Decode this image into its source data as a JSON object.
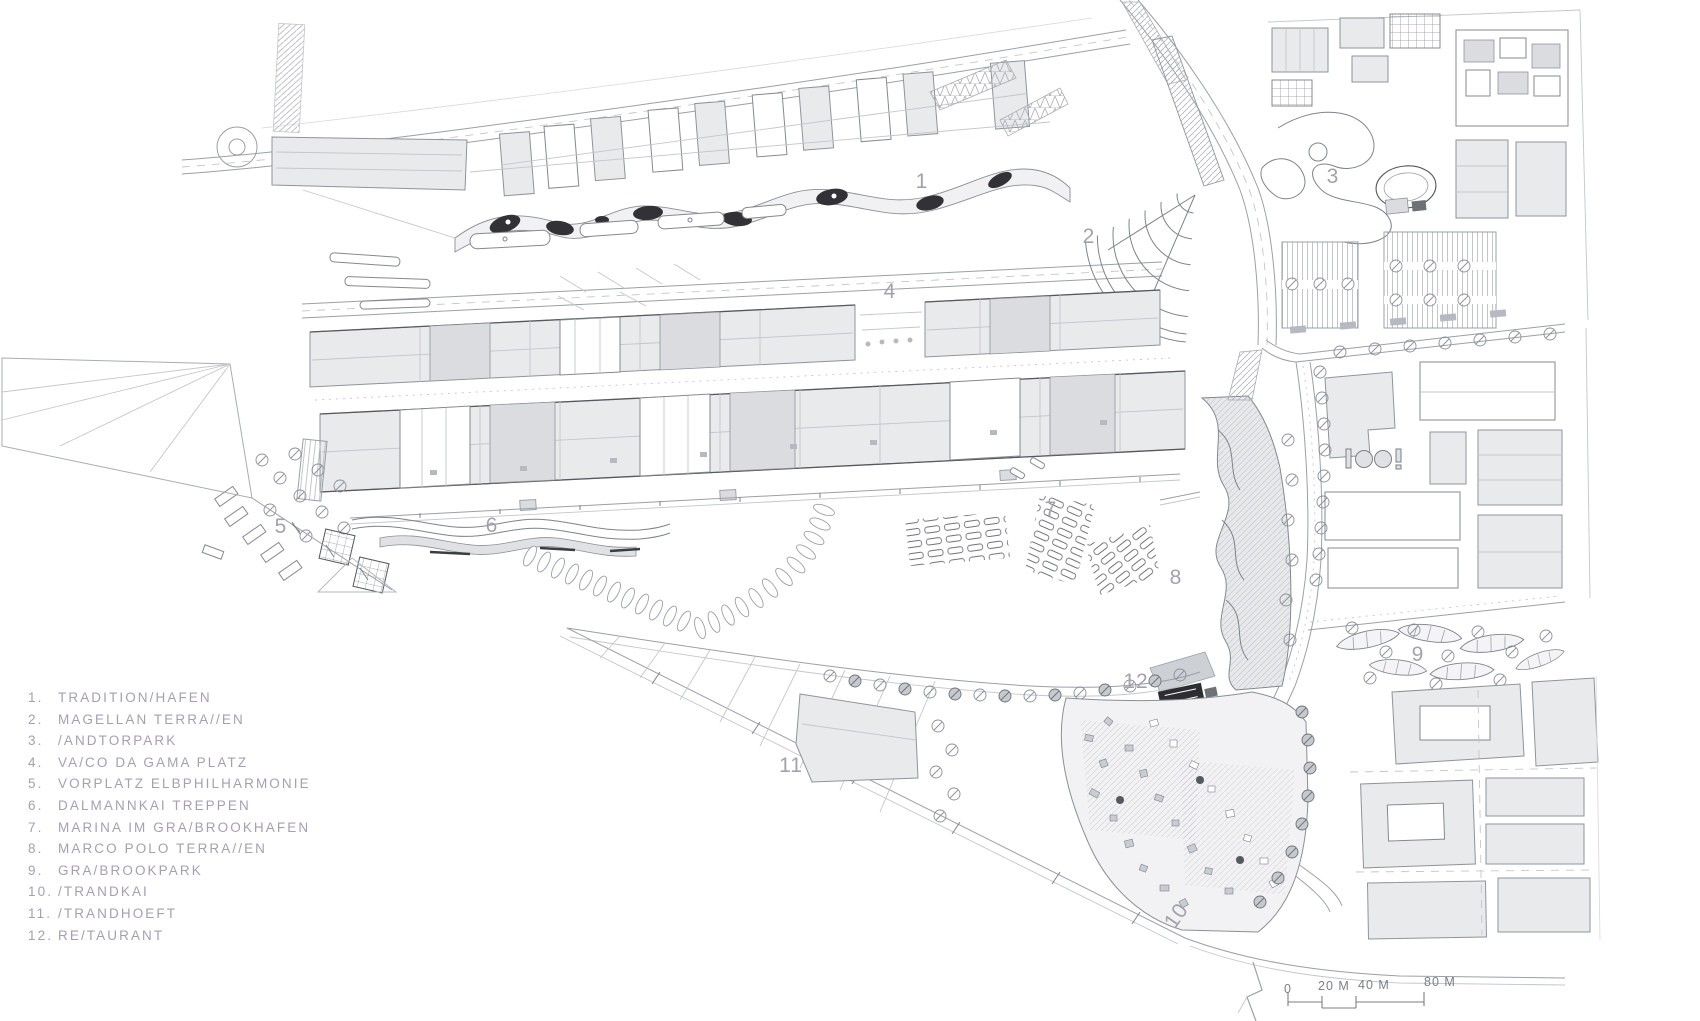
{
  "legend": {
    "items": [
      {
        "num": "1.",
        "label": "TRADITION/HAFEN"
      },
      {
        "num": "2.",
        "label": "MAGELLAN TERRA//EN"
      },
      {
        "num": "3.",
        "label": "/ANDTORPARK"
      },
      {
        "num": "4.",
        "label": "VA/CO DA GAMA PLATZ"
      },
      {
        "num": "5.",
        "label": "VORPLATZ ELBPHILHARMONIE"
      },
      {
        "num": "6.",
        "label": "DALMANNKAI TREPPEN"
      },
      {
        "num": "7.",
        "label": "MARINA IM GRA/BROOKHAFEN"
      },
      {
        "num": "8.",
        "label": "MARCO POLO TERRA//EN"
      },
      {
        "num": "9.",
        "label": "GRA/BROOKPARK"
      },
      {
        "num": "10.",
        "label": "/TRANDKAI"
      },
      {
        "num": "11.",
        "label": "/TRANDHOEFT"
      },
      {
        "num": "12.",
        "label": "RE/TAURANT"
      }
    ]
  },
  "plan_labels": [
    {
      "n": "1"
    },
    {
      "n": "2"
    },
    {
      "n": "3"
    },
    {
      "n": "4"
    },
    {
      "n": "5"
    },
    {
      "n": "6"
    },
    {
      "n": "7"
    },
    {
      "n": "8"
    },
    {
      "n": "9"
    },
    {
      "n": "10"
    },
    {
      "n": "11"
    },
    {
      "n": "12"
    }
  ],
  "scale_bar": {
    "zero": "0",
    "t20": "20 M",
    "t40": "40 M",
    "t80": "80 M"
  },
  "colors": {
    "paper": "#ffffff",
    "ink": "#6d7277",
    "line_light": "#b3b8be",
    "building_fill": "#e9eaec",
    "dark_accent": "#323236",
    "legend_text": "#a59fb0"
  }
}
